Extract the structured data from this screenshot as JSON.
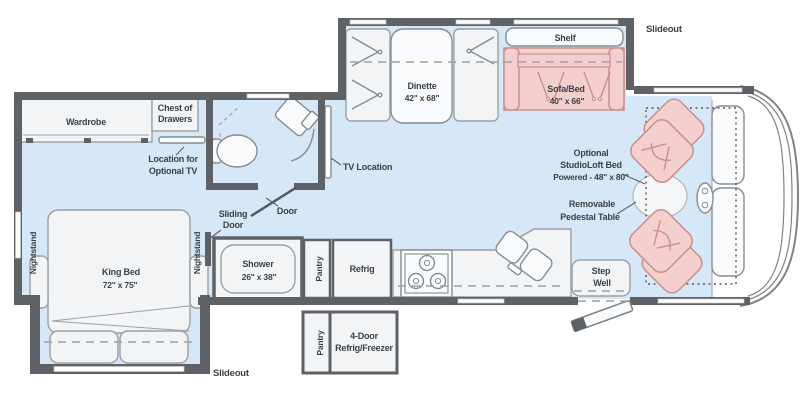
{
  "diagram_type": "rv-floorplan",
  "colors": {
    "floor": "#d6e8f7",
    "wall": "#5e6266",
    "furniture": "#f2f4f5",
    "accent_pink": "#f3cfce",
    "accent_pink_border": "#c9908c",
    "label_text": "#3d4247"
  },
  "labels": {
    "slideout_top": "Slideout",
    "slideout_bottom": "Slideout",
    "wardrobe": "Wardrobe",
    "chest": {
      "l1": "Chest of",
      "l2": "Drawers"
    },
    "optional_tv": {
      "l1": "Location for",
      "l2": "Optional TV"
    },
    "tv_location": "TV Location",
    "dinette": {
      "l1": "Dinette",
      "l2": "42\" x 68\""
    },
    "shelf": "Shelf",
    "sofa_bed": {
      "l1": "Sofa/Bed",
      "l2": "40\" x 66\""
    },
    "studioloft": {
      "l1": "Optional",
      "l2": "StudioLoft Bed",
      "l3": "Powered - 48\" x 80\""
    },
    "pedestal_table": {
      "l1": "Removable",
      "l2": "Pedestal Table"
    },
    "king_bed": {
      "l1": "King Bed",
      "l2": "72\" x 75\""
    },
    "nightstand_left": "Nightstand",
    "nightstand_right": "Nightstand",
    "sliding_door": {
      "l1": "Sliding",
      "l2": "Door"
    },
    "door": "Door",
    "shower": {
      "l1": "Shower",
      "l2": "26\" x 38\""
    },
    "pantry_main": "Pantry",
    "refrig": "Refrig",
    "step_well": {
      "l1": "Step",
      "l2": "Well"
    },
    "pantry_lower": "Pantry",
    "four_door": {
      "l1": "4-Door",
      "l2": "Refrig/Freezer"
    }
  }
}
